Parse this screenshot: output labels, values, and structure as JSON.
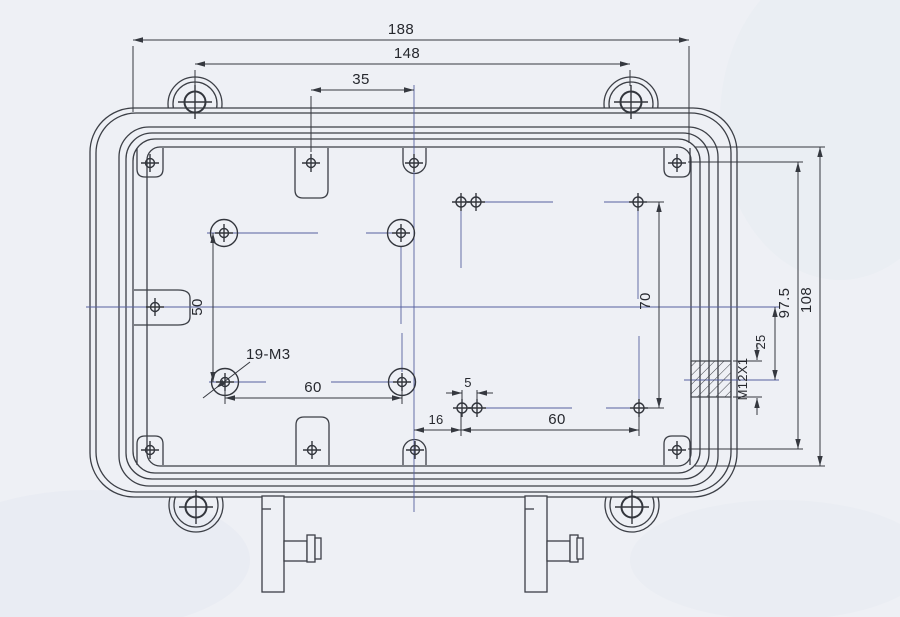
{
  "labels": {
    "overall_width": "188",
    "mount_spacing": "148",
    "tab_offset": "35",
    "left_pattern_height": "50",
    "left_pattern_width": "60",
    "thread_note": "19-M3",
    "right_pattern_height": "70",
    "right_pattern_width": "60",
    "pair_gap": "5",
    "edge_offset": "16",
    "corner_screw_span": "97.5",
    "inner_height": "108",
    "gland_offset": "25",
    "gland_thread": "M12X1"
  },
  "colors": {
    "paper": "#eef0f5",
    "line": "#3c3f46",
    "centerline": "#5560a0"
  }
}
